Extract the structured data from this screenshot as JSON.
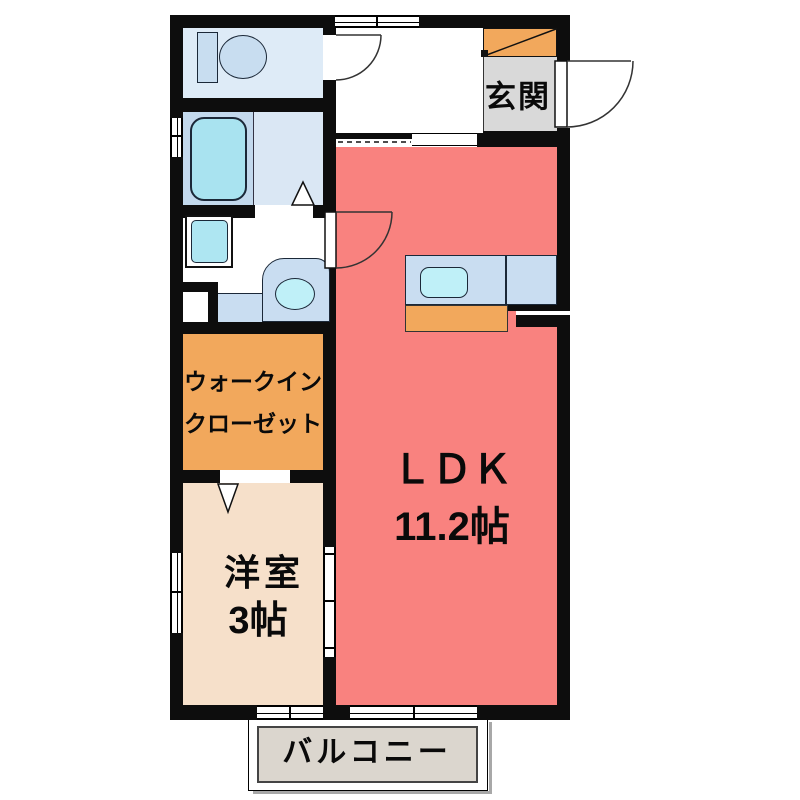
{
  "floorplan": {
    "rooms": {
      "genkan": {
        "label": "玄関"
      },
      "ldk": {
        "name_line": "ＬＤＫ",
        "size_line": "11.2帖"
      },
      "walk_in_closet": {
        "line1": "ウォークイン",
        "line2": "クローゼット"
      },
      "western_room": {
        "line1": "洋室",
        "line2": "3帖"
      },
      "balcony": {
        "label": "バルコニー"
      }
    },
    "fixtures": [
      "toilet",
      "bathtub",
      "washing-machine",
      "washbasin",
      "kitchen-sink",
      "shoe-cabinet"
    ],
    "colors": {
      "wall": "#0d0d0d",
      "ldk": "#f9827f",
      "western-room": "#f6e0ca",
      "closet": "#f2a85c",
      "genkan": "#d9d9d9",
      "balcony": "#dbd6ce",
      "counter": "#c9ddf1",
      "sink": "#bff0f8",
      "tub": "#a9e3f0",
      "toilet-room": "#deebf7",
      "bath": "#dae7f4",
      "bath-left": "#c3d9ed"
    }
  }
}
